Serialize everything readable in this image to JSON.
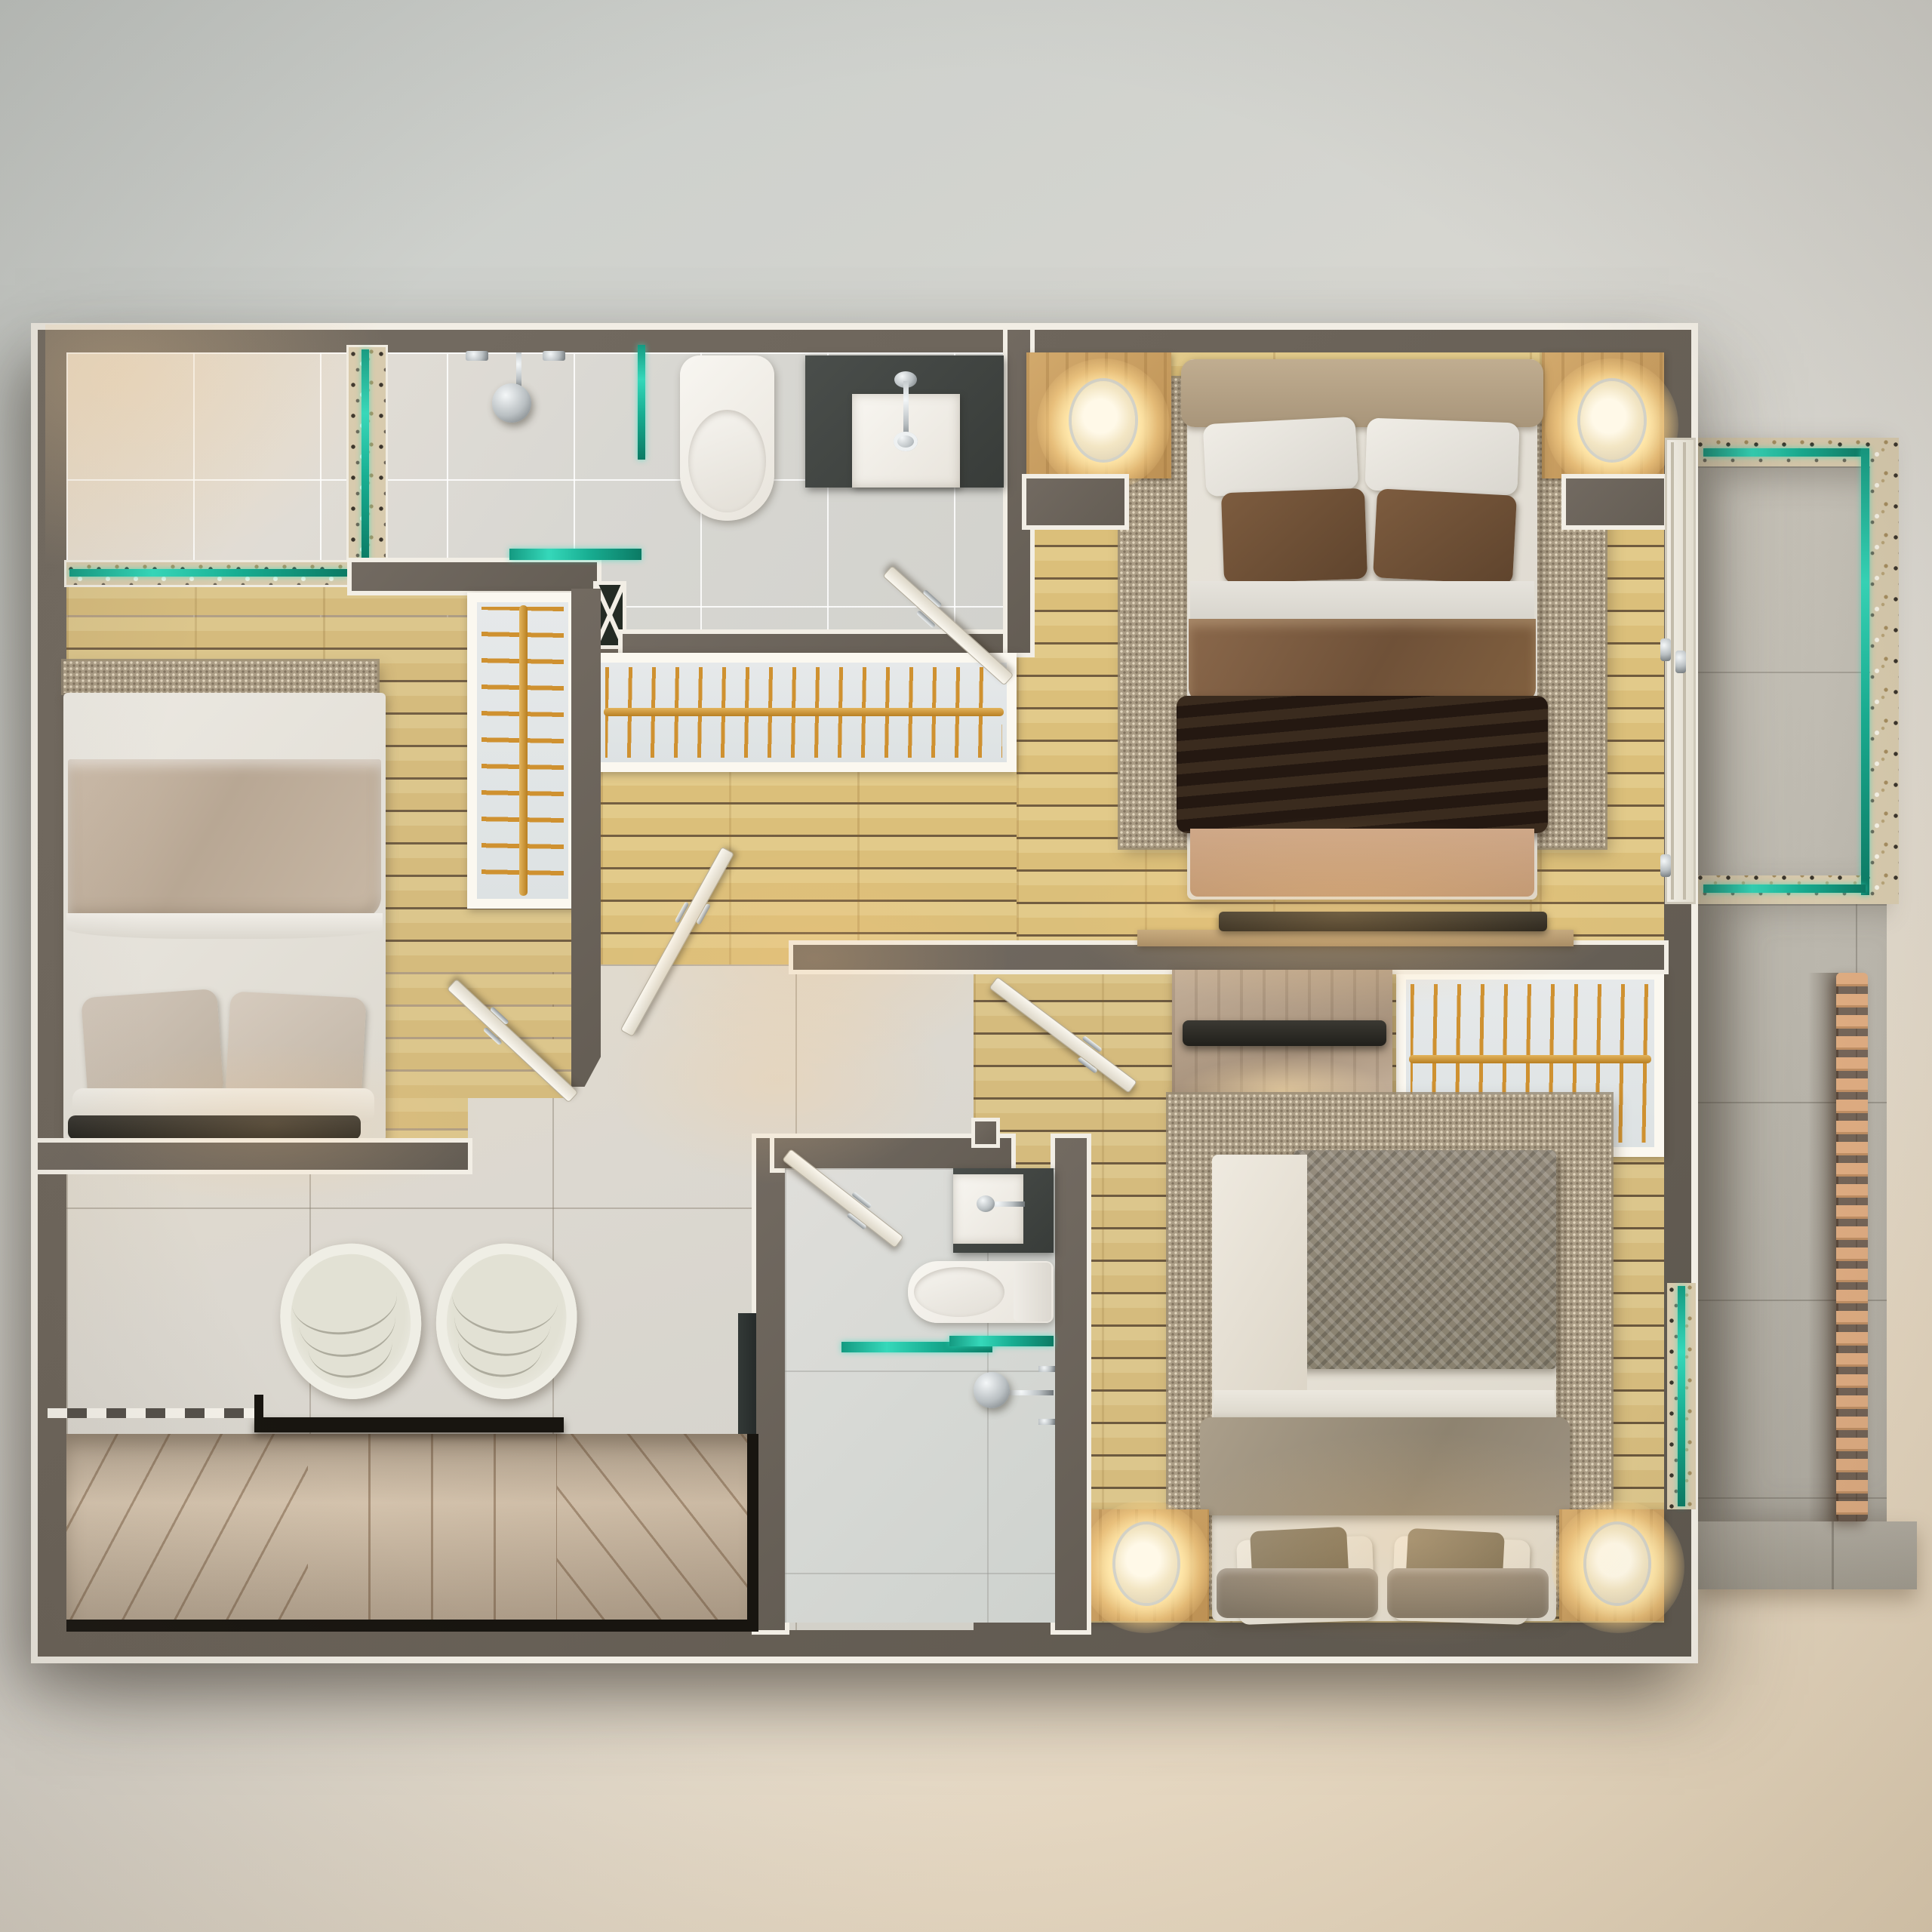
{
  "scene": {
    "title": "Top-down 3D render – apartment upper floor plan",
    "description": "Photorealistic overhead floor plan with three bedrooms, two bathrooms, walk-in closet hall, stair landing with lounge chairs, and a glass-railed balcony with terrace walkway"
  },
  "palette": {
    "wall": "#6b635a",
    "wall_shadow": "#5c564e",
    "trim": "#f2eee5",
    "tile_bath": "#dcd9d3",
    "tile_landing": "#d9d6ce",
    "wood": "#d7bd82",
    "wood_dark": "#b59a5e",
    "terrazzo": "#d8cbae",
    "glass_teal": "#1fb598",
    "rack_frame": "#fbf8f0",
    "rack_bg": "#e2e6e7",
    "hanger_gold": "#cd9032",
    "rug": "#ab9d86",
    "bed_white": "#e7e3da",
    "blanket_taupe": "#c3b3a1",
    "duvet_brown": "#7b5b41",
    "throw_dark": "#31241a",
    "pillow_brown": "#6e5036",
    "headboard_tan": "#b4a186",
    "foot_tan": "#c79f80",
    "knit_grey": "#8f8678",
    "cushion_grey": "#8d8173",
    "nightstand_wood": "#c79e63",
    "lamp_glow": "#ffe8b5",
    "chair_shell": "#ecebe2",
    "chair_cushion": "#dbdacc",
    "stair_marble": "#d6c4ae",
    "stair_rail": "#181510",
    "slate": "#434744",
    "porcelain": "#f5f3ee",
    "chrome": "#c6cbcd",
    "balcony_tile": "#c7c3b9",
    "terrace_tile": "#b7b3a9",
    "ledge_stone": "#aca79c",
    "slat_wood": "#d8a47d",
    "tv_dark": "#26241f",
    "console_wood": "#b59b77",
    "dresser_wood": "#b7a490",
    "dark_glass": "#2b2d2c"
  },
  "rooms": [
    {
      "name": "En-suite bathroom (top left)",
      "floor": "large porcelain tile",
      "features": [
        "open walk-in shower",
        "terrazzo drain strips with teal glass",
        "ceiling shower head",
        "wall-hung toilet",
        "slate vanity with square basin",
        "teal glass shelf and partition"
      ]
    },
    {
      "name": "Bedroom 1 (left)",
      "floor": "oak plank",
      "features": [
        "double bed with taupe throw",
        "woven rug runner at head wall",
        "open wardrobe rack with gold hangers"
      ]
    },
    {
      "name": "Closet hall (center)",
      "floor": "oak plank",
      "features": [
        "long open wardrobe rack",
        "service shaft marked with X",
        "door to landing"
      ]
    },
    {
      "name": "Master bedroom (top right)",
      "floor": "oak plank",
      "features": [
        "double bed with brown duvet and dark throw",
        "two nightstand nooks with glowing sconce lamps",
        "large woven area rug",
        "TV console on dividing wall",
        "sliding glass door to balcony"
      ]
    },
    {
      "name": "Bedroom 2 (bottom right)",
      "floor": "oak plank",
      "features": [
        "double bed with chunky-knit grey throw",
        "grey-washed dresser with TV",
        "open wardrobe rack",
        "two nightstands with glowing lamps",
        "terrazzo window sill with teal glazing"
      ]
    },
    {
      "name": "Bathroom 2 (bottom center)",
      "floor": "porcelain tile",
      "features": [
        "slate vanity with square basin",
        "wall-hung toilet",
        "teal glass shelves",
        "hand shower with chrome valves"
      ]
    },
    {
      "name": "Landing lounge (bottom left)",
      "floor": "large porcelain tile",
      "features": [
        "two round lounge chairs",
        "open stairwell with black railing",
        "marble winder treads",
        "dashed opening mark"
      ]
    },
    {
      "name": "Balcony (right)",
      "floor": "stone tile",
      "features": [
        "terrazzo border",
        "teal glass balustrade"
      ]
    },
    {
      "name": "Terrace walkway (lower right)",
      "floor": "stone tile",
      "features": [
        "wood louver slats",
        "stone ledge"
      ]
    }
  ],
  "counts": {
    "beds": 3,
    "wardrobe_racks": 3,
    "doors": 5,
    "lounge_chairs": 2,
    "toilets": 2,
    "sinks": 2,
    "showers": 2,
    "bedside_lamps": 4,
    "tvs": 2
  }
}
